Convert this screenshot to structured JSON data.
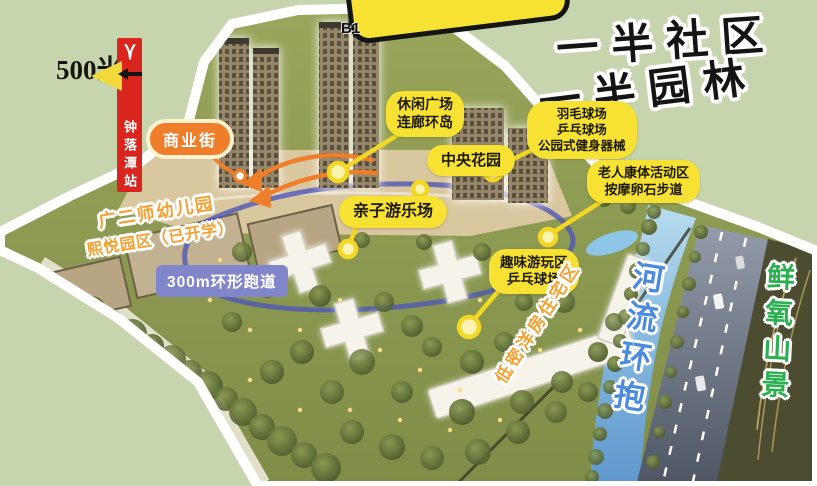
{
  "slogan": {
    "line1": "一半社区",
    "line2": "一半园林"
  },
  "scale": {
    "distance": "500米"
  },
  "metro": {
    "station": "钟落潭站",
    "logo": "guangzhou-metro-y-icon"
  },
  "callouts": {
    "tower_id": "B1",
    "commercial": {
      "label": "商业街"
    },
    "leisure": {
      "line1": "休闲广场",
      "line2": "连廊环岛"
    },
    "sports": {
      "line1": "羽毛球场",
      "line2": "乒乓球场",
      "line3": "公园式健身器械"
    },
    "central_garden": {
      "label": "中央花园"
    },
    "elderly": {
      "line1": "老人康体活动区",
      "line2": "按摩卵石步道"
    },
    "family_play": {
      "label": "亲子游乐场"
    },
    "fun_zone": {
      "line1": "趣味游玩区",
      "line2": "乒乓球场"
    },
    "track": {
      "label": "300m环形跑道"
    },
    "kindergarten": {
      "line1": "广二师幼儿园",
      "line2": "熙悦园区（已开学）"
    },
    "low_density": {
      "label": "低密洋房住宅区"
    },
    "river": {
      "label": "河流环抱"
    },
    "mountain": {
      "label": "鲜氧山景"
    }
  },
  "colors": {
    "bg": "#c7d5ae",
    "yellow": "#f7e234",
    "orange": "#ef7e2a",
    "periwinkle": "#8186cb",
    "red": "#d9251d",
    "blue-text": "#4a8be0",
    "green-text": "#2bb04f",
    "orange-text": "#f6a02f"
  }
}
